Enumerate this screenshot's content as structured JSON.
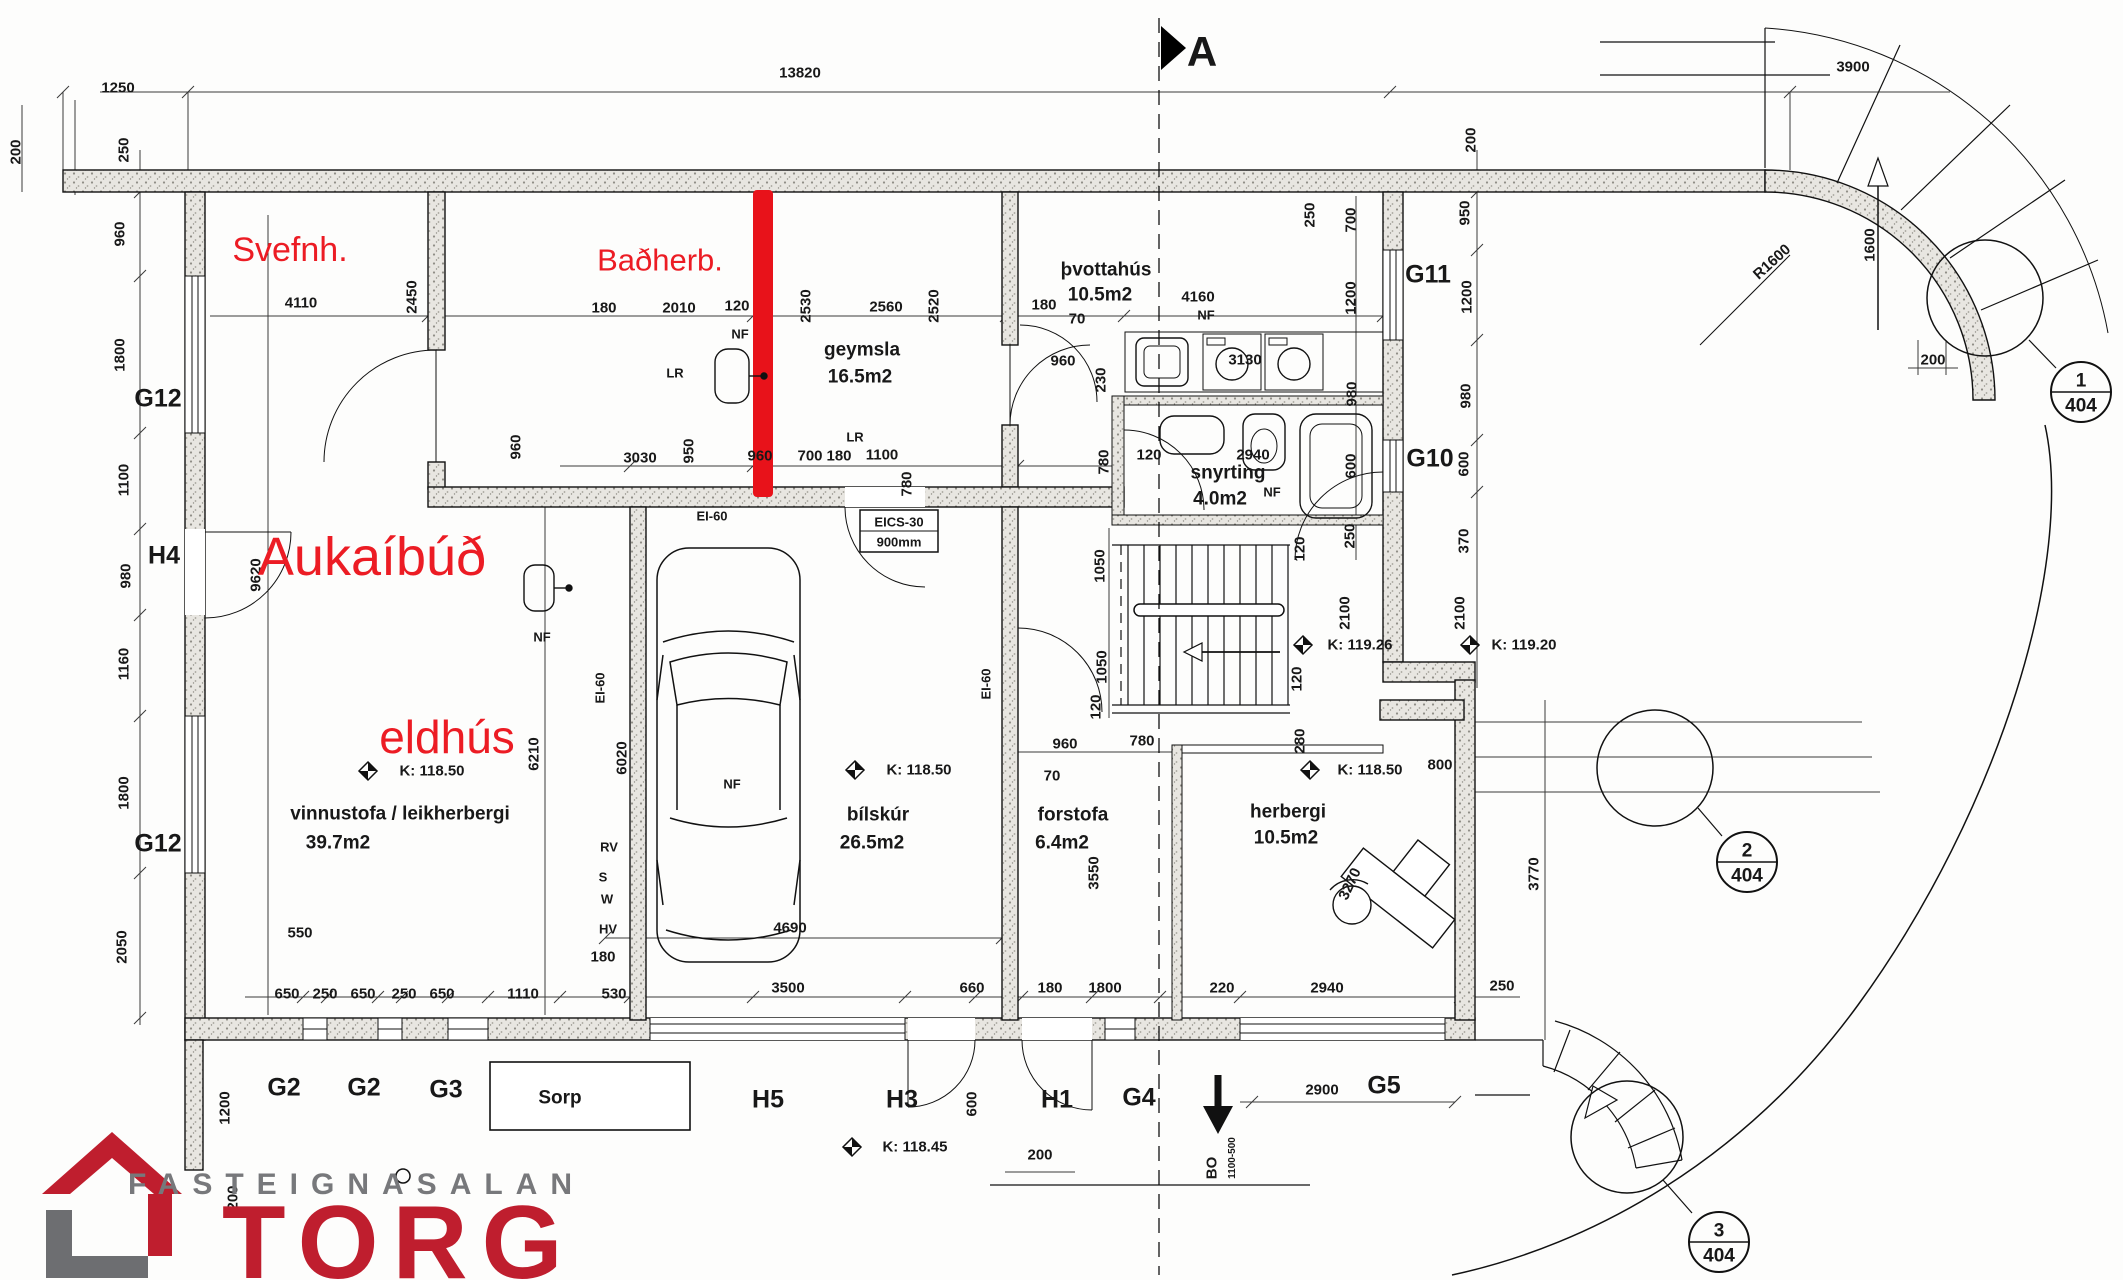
{
  "logo": {
    "top_text": "FASTEIGNASALAN",
    "name": "TORG",
    "red": "#bf1e2e",
    "gray": "#77787b"
  },
  "colors": {
    "annotation_red": "#ec1c24",
    "marker_red": "#e8121a",
    "line": "#181818",
    "wall_fill": "#e8e6e1"
  },
  "labels": [
    {
      "t": "1250",
      "x": 118,
      "y": 88,
      "c": "d"
    },
    {
      "t": "13820",
      "x": 800,
      "y": 73,
      "c": "d"
    },
    {
      "t": "3900",
      "x": 1853,
      "y": 67,
      "c": "d"
    },
    {
      "t": "A",
      "x": 1202,
      "y": 52,
      "c": "sec",
      "n": "section-marker-a"
    },
    {
      "t": "200",
      "x": 16,
      "y": 152,
      "c": "v"
    },
    {
      "t": "250",
      "x": 124,
      "y": 150,
      "c": "v"
    },
    {
      "t": "960",
      "x": 120,
      "y": 234,
      "c": "v"
    },
    {
      "t": "1800",
      "x": 120,
      "y": 355,
      "c": "v"
    },
    {
      "t": "G12",
      "x": 158,
      "y": 399,
      "c": "w",
      "n": "wall-label-g12-upper"
    },
    {
      "t": "1100",
      "x": 124,
      "y": 480,
      "c": "v"
    },
    {
      "t": "H4",
      "x": 164,
      "y": 556,
      "c": "w",
      "n": "wall-label-h4"
    },
    {
      "t": "980",
      "x": 126,
      "y": 576,
      "c": "v"
    },
    {
      "t": "1160",
      "x": 124,
      "y": 664,
      "c": "v"
    },
    {
      "t": "1800",
      "x": 124,
      "y": 793,
      "c": "v"
    },
    {
      "t": "G12",
      "x": 158,
      "y": 844,
      "c": "w",
      "n": "wall-label-g12-lower"
    },
    {
      "t": "2050",
      "x": 122,
      "y": 947,
      "c": "v"
    },
    {
      "t": "1200",
      "x": 225,
      "y": 1108,
      "c": "v"
    },
    {
      "t": "200",
      "x": 233,
      "y": 1198,
      "c": "v"
    },
    {
      "t": "9620",
      "x": 256,
      "y": 575,
      "c": "v"
    },
    {
      "t": "Svefnh.",
      "x": 290,
      "y": 250,
      "c": "r1",
      "n": "annotation-svefnh"
    },
    {
      "t": "Baðherb.",
      "x": 660,
      "y": 260,
      "c": "r2",
      "n": "annotation-badherb"
    },
    {
      "t": "Aukaíbúð",
      "x": 372,
      "y": 557,
      "c": "r3",
      "n": "annotation-aukaibud"
    },
    {
      "t": "eldhús",
      "x": 447,
      "y": 737,
      "c": "r4",
      "n": "annotation-eldhus"
    },
    {
      "t": "4110",
      "x": 301,
      "y": 303,
      "c": "d"
    },
    {
      "t": "2450",
      "x": 412,
      "y": 297,
      "c": "v"
    },
    {
      "t": "180",
      "x": 604,
      "y": 308,
      "c": "d"
    },
    {
      "t": "2010",
      "x": 679,
      "y": 308,
      "c": "d"
    },
    {
      "t": "120",
      "x": 737,
      "y": 306,
      "c": "d"
    },
    {
      "t": "2530",
      "x": 806,
      "y": 306,
      "c": "v"
    },
    {
      "t": "2560",
      "x": 886,
      "y": 307,
      "c": "d"
    },
    {
      "t": "2520",
      "x": 934,
      "y": 306,
      "c": "v"
    },
    {
      "t": "180",
      "x": 1044,
      "y": 305,
      "c": "d"
    },
    {
      "t": "NF",
      "x": 740,
      "y": 334,
      "c": "s"
    },
    {
      "t": "LR",
      "x": 675,
      "y": 373,
      "c": "s"
    },
    {
      "t": "LR",
      "x": 855,
      "y": 437,
      "c": "s"
    },
    {
      "t": "geymsla",
      "x": 862,
      "y": 350,
      "c": "r",
      "n": "room-label-geymsla"
    },
    {
      "t": "16.5m2",
      "x": 860,
      "y": 377,
      "c": "r"
    },
    {
      "t": "þvottahús",
      "x": 1106,
      "y": 270,
      "c": "r",
      "n": "room-label-thvottahus"
    },
    {
      "t": "10.5m2",
      "x": 1100,
      "y": 295,
      "c": "r"
    },
    {
      "t": "70",
      "x": 1077,
      "y": 319,
      "c": "d"
    },
    {
      "t": "4160",
      "x": 1198,
      "y": 297,
      "c": "d"
    },
    {
      "t": "NF",
      "x": 1206,
      "y": 315,
      "c": "s"
    },
    {
      "t": "960",
      "x": 1063,
      "y": 361,
      "c": "d"
    },
    {
      "t": "230",
      "x": 1101,
      "y": 380,
      "c": "v"
    },
    {
      "t": "3130",
      "x": 1245,
      "y": 360,
      "c": "d"
    },
    {
      "t": "250",
      "x": 1310,
      "y": 215,
      "c": "v"
    },
    {
      "t": "700",
      "x": 1351,
      "y": 220,
      "c": "v"
    },
    {
      "t": "1200",
      "x": 1351,
      "y": 298,
      "c": "v"
    },
    {
      "t": "G11",
      "x": 1428,
      "y": 275,
      "c": "w",
      "n": "wall-label-g11"
    },
    {
      "t": "950",
      "x": 1465,
      "y": 213,
      "c": "v"
    },
    {
      "t": "1200",
      "x": 1467,
      "y": 297,
      "c": "v"
    },
    {
      "t": "980",
      "x": 1466,
      "y": 396,
      "c": "v"
    },
    {
      "t": "980",
      "x": 1352,
      "y": 394,
      "c": "v"
    },
    {
      "t": "960",
      "x": 516,
      "y": 447,
      "c": "v"
    },
    {
      "t": "3030",
      "x": 640,
      "y": 458,
      "c": "d"
    },
    {
      "t": "950",
      "x": 689,
      "y": 451,
      "c": "v"
    },
    {
      "t": "960",
      "x": 760,
      "y": 456,
      "c": "d"
    },
    {
      "t": "700",
      "x": 810,
      "y": 456,
      "c": "d"
    },
    {
      "t": "180",
      "x": 839,
      "y": 456,
      "c": "d"
    },
    {
      "t": "1100",
      "x": 882,
      "y": 455,
      "c": "d"
    },
    {
      "t": "780",
      "x": 907,
      "y": 484,
      "c": "v"
    },
    {
      "t": "780",
      "x": 1104,
      "y": 462,
      "c": "v"
    },
    {
      "t": "120",
      "x": 1149,
      "y": 455,
      "c": "d"
    },
    {
      "t": "2940",
      "x": 1253,
      "y": 455,
      "c": "d"
    },
    {
      "t": "snyrting",
      "x": 1228,
      "y": 473,
      "c": "r",
      "n": "room-label-snyrting"
    },
    {
      "t": "4.0m2",
      "x": 1220,
      "y": 499,
      "c": "r"
    },
    {
      "t": "NF",
      "x": 1272,
      "y": 492,
      "c": "s"
    },
    {
      "t": "600",
      "x": 1351,
      "y": 466,
      "c": "v"
    },
    {
      "t": "G10",
      "x": 1430,
      "y": 459,
      "c": "w",
      "n": "wall-label-g10"
    },
    {
      "t": "600",
      "x": 1464,
      "y": 464,
      "c": "v"
    },
    {
      "t": "250",
      "x": 1350,
      "y": 536,
      "c": "v"
    },
    {
      "t": "120",
      "x": 1300,
      "y": 549,
      "c": "v"
    },
    {
      "t": "370",
      "x": 1464,
      "y": 541,
      "c": "v"
    },
    {
      "t": "EI-60",
      "x": 712,
      "y": 516,
      "c": "s"
    },
    {
      "t": "EI-60",
      "x": 600,
      "y": 688,
      "c": "sv"
    },
    {
      "t": "EI-60",
      "x": 986,
      "y": 684,
      "c": "sv"
    },
    {
      "t": "EICS-30",
      "x": 899,
      "y": 522,
      "c": "s"
    },
    {
      "t": "900mm",
      "x": 899,
      "y": 542,
      "c": "s"
    },
    {
      "t": "NF",
      "x": 542,
      "y": 637,
      "c": "s"
    },
    {
      "t": "K: 118.50",
      "x": 432,
      "y": 771,
      "c": "k"
    },
    {
      "t": "vinnustofa / leikherbergi",
      "x": 400,
      "y": 814,
      "c": "r",
      "n": "room-label-vinnustofa"
    },
    {
      "t": "39.7m2",
      "x": 338,
      "y": 843,
      "c": "r"
    },
    {
      "t": "550",
      "x": 300,
      "y": 933,
      "c": "d"
    },
    {
      "t": "6210",
      "x": 534,
      "y": 754,
      "c": "v"
    },
    {
      "t": "6020",
      "x": 622,
      "y": 758,
      "c": "v"
    },
    {
      "t": "RV",
      "x": 609,
      "y": 847,
      "c": "s"
    },
    {
      "t": "S",
      "x": 603,
      "y": 877,
      "c": "s"
    },
    {
      "t": "W",
      "x": 607,
      "y": 899,
      "c": "s"
    },
    {
      "t": "HV",
      "x": 608,
      "y": 929,
      "c": "s"
    },
    {
      "t": "180",
      "x": 603,
      "y": 957,
      "c": "d"
    },
    {
      "t": "NF",
      "x": 732,
      "y": 784,
      "c": "s"
    },
    {
      "t": "K: 118.50",
      "x": 919,
      "y": 770,
      "c": "k"
    },
    {
      "t": "bílskúr",
      "x": 878,
      "y": 815,
      "c": "r",
      "n": "room-label-bilskur"
    },
    {
      "t": "26.5m2",
      "x": 872,
      "y": 843,
      "c": "r"
    },
    {
      "t": "4690",
      "x": 790,
      "y": 928,
      "c": "d"
    },
    {
      "t": "1050",
      "x": 1100,
      "y": 566,
      "c": "v"
    },
    {
      "t": "1050",
      "x": 1102,
      "y": 667,
      "c": "v"
    },
    {
      "t": "120",
      "x": 1096,
      "y": 707,
      "c": "v"
    },
    {
      "t": "120",
      "x": 1297,
      "y": 679,
      "c": "v"
    },
    {
      "t": "2100",
      "x": 1345,
      "y": 613,
      "c": "v"
    },
    {
      "t": "2100",
      "x": 1460,
      "y": 613,
      "c": "v"
    },
    {
      "t": "K: 119.26",
      "x": 1360,
      "y": 645,
      "c": "k"
    },
    {
      "t": "K: 119.20",
      "x": 1524,
      "y": 645,
      "c": "k"
    },
    {
      "t": "960",
      "x": 1065,
      "y": 744,
      "c": "d"
    },
    {
      "t": "780",
      "x": 1142,
      "y": 741,
      "c": "d"
    },
    {
      "t": "70",
      "x": 1052,
      "y": 776,
      "c": "d"
    },
    {
      "t": "forstofa",
      "x": 1073,
      "y": 815,
      "c": "r",
      "n": "room-label-forstofa"
    },
    {
      "t": "6.4m2",
      "x": 1062,
      "y": 843,
      "c": "r"
    },
    {
      "t": "3550",
      "x": 1094,
      "y": 873,
      "c": "v"
    },
    {
      "t": "280",
      "x": 1300,
      "y": 741,
      "c": "v"
    },
    {
      "t": "800",
      "x": 1440,
      "y": 765,
      "c": "d"
    },
    {
      "t": "K: 118.50",
      "x": 1370,
      "y": 770,
      "c": "k"
    },
    {
      "t": "herbergi",
      "x": 1288,
      "y": 812,
      "c": "r",
      "n": "room-label-herbergi"
    },
    {
      "t": "10.5m2",
      "x": 1286,
      "y": 838,
      "c": "r"
    },
    {
      "t": "3270",
      "x": 1350,
      "y": 884,
      "c": "v65"
    },
    {
      "t": "3770",
      "x": 1534,
      "y": 874,
      "c": "v"
    },
    {
      "t": "530",
      "x": 614,
      "y": 994,
      "c": "d"
    },
    {
      "t": "3500",
      "x": 788,
      "y": 988,
      "c": "d"
    },
    {
      "t": "660",
      "x": 972,
      "y": 988,
      "c": "d"
    },
    {
      "t": "180",
      "x": 1050,
      "y": 988,
      "c": "d"
    },
    {
      "t": "1800",
      "x": 1105,
      "y": 988,
      "c": "d"
    },
    {
      "t": "220",
      "x": 1222,
      "y": 988,
      "c": "d"
    },
    {
      "t": "2940",
      "x": 1327,
      "y": 988,
      "c": "d"
    },
    {
      "t": "250",
      "x": 1502,
      "y": 986,
      "c": "d"
    },
    {
      "t": "650",
      "x": 287,
      "y": 994,
      "c": "d"
    },
    {
      "t": "250",
      "x": 325,
      "y": 994,
      "c": "d"
    },
    {
      "t": "650",
      "x": 363,
      "y": 994,
      "c": "d"
    },
    {
      "t": "250",
      "x": 404,
      "y": 994,
      "c": "d"
    },
    {
      "t": "650",
      "x": 442,
      "y": 994,
      "c": "d"
    },
    {
      "t": "1110",
      "x": 523,
      "y": 994,
      "c": "d"
    },
    {
      "t": "G2",
      "x": 284,
      "y": 1088,
      "c": "w",
      "n": "wall-label-g2-a"
    },
    {
      "t": "G2",
      "x": 364,
      "y": 1088,
      "c": "w",
      "n": "wall-label-g2-b"
    },
    {
      "t": "G3",
      "x": 446,
      "y": 1090,
      "c": "w",
      "n": "wall-label-g3"
    },
    {
      "t": "Sorp",
      "x": 560,
      "y": 1098,
      "c": "r",
      "n": "sorp-label"
    },
    {
      "t": "H5",
      "x": 768,
      "y": 1100,
      "c": "w",
      "n": "wall-label-h5"
    },
    {
      "t": "H3",
      "x": 902,
      "y": 1100,
      "c": "w",
      "n": "wall-label-h3"
    },
    {
      "t": "600",
      "x": 972,
      "y": 1104,
      "c": "v"
    },
    {
      "t": "H1",
      "x": 1057,
      "y": 1100,
      "c": "w",
      "n": "wall-label-h1"
    },
    {
      "t": "G4",
      "x": 1139,
      "y": 1098,
      "c": "w",
      "n": "wall-label-g4"
    },
    {
      "t": "200",
      "x": 1040,
      "y": 1155,
      "c": "d"
    },
    {
      "t": "K: 118.45",
      "x": 915,
      "y": 1147,
      "c": "k"
    },
    {
      "t": "BO",
      "x": 1212,
      "y": 1168,
      "c": "v",
      "n": "bo-label"
    },
    {
      "t": "1100-500",
      "x": 1233,
      "y": 1158,
      "c": "vs"
    },
    {
      "t": "2900",
      "x": 1322,
      "y": 1090,
      "c": "d"
    },
    {
      "t": "G5",
      "x": 1384,
      "y": 1086,
      "c": "w",
      "n": "wall-label-g5"
    },
    {
      "t": "200",
      "x": 1471,
      "y": 140,
      "c": "v"
    },
    {
      "t": "R1600",
      "x": 1772,
      "y": 262,
      "c": "r45"
    },
    {
      "t": "1600",
      "x": 1870,
      "y": 245,
      "c": "v"
    },
    {
      "t": "200",
      "x": 1933,
      "y": 360,
      "c": "d"
    },
    {
      "t": "1",
      "x": 2081,
      "y": 381,
      "c": "b",
      "n": "detail-badge-1-num"
    },
    {
      "t": "404",
      "x": 2081,
      "y": 406,
      "c": "b",
      "n": "detail-badge-1-sheet"
    },
    {
      "t": "2",
      "x": 1747,
      "y": 851,
      "c": "b",
      "n": "detail-badge-2-num"
    },
    {
      "t": "404",
      "x": 1747,
      "y": 876,
      "c": "b",
      "n": "detail-badge-2-sheet"
    },
    {
      "t": "3",
      "x": 1719,
      "y": 1231,
      "c": "b",
      "n": "detail-badge-3-num"
    },
    {
      "t": "404",
      "x": 1719,
      "y": 1256,
      "c": "b",
      "n": "detail-badge-3-sheet"
    }
  ]
}
